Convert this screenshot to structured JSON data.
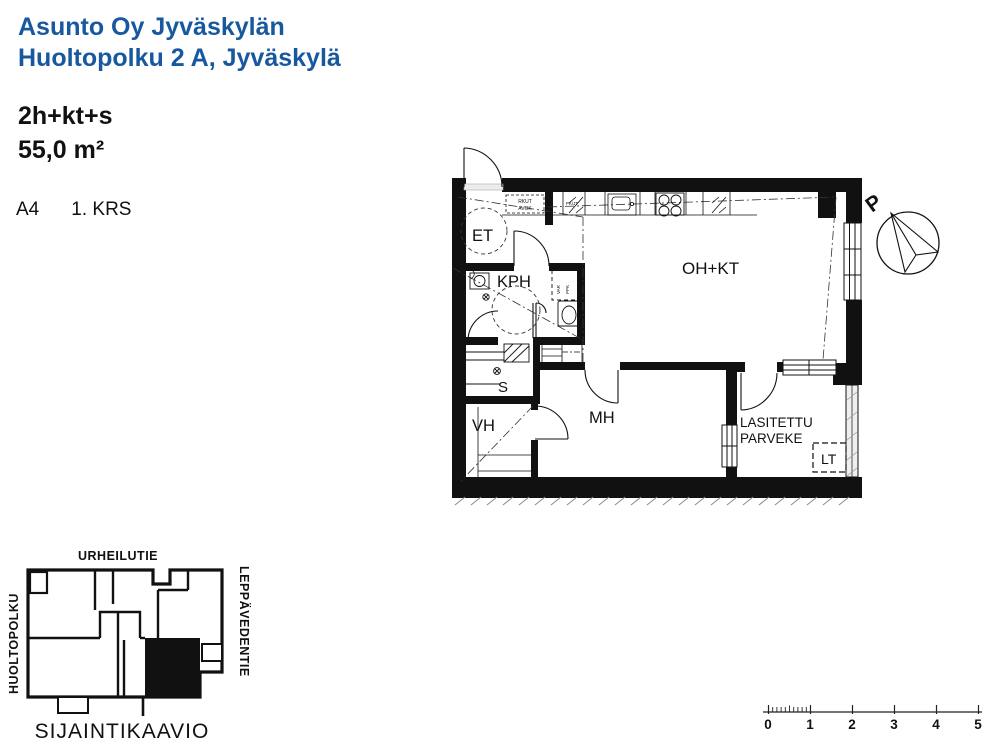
{
  "header": {
    "title_line1": "Asunto Oy Jyväskylän",
    "title_line2": "Huoltopolku 2 A, Jyväskylä",
    "apartment_type": "2h+kt+s",
    "area": "55,0 m²",
    "unit_id": "A4",
    "floor": "1. KRS"
  },
  "floor_plan": {
    "rooms": {
      "entry": "ET",
      "bathroom": "KPH",
      "sauna": "S",
      "closet": "VH",
      "bedroom": "MH",
      "living_kitchen": "OH+KT",
      "balcony_line1": "LASITETTU",
      "balcony_line2": "PARVEKE",
      "balcony_storage": "LT"
    },
    "kitchen_cabinet_label_line1": "RKUT",
    "kitchen_cabinet_label_line2": "AVOK",
    "kitchen_small_label": "PK/JT",
    "laundry_label_line1": "VAR",
    "laundry_label_line2": "PPK",
    "compass_north": "P"
  },
  "site_map": {
    "street_top": "URHEILUTIE",
    "street_left": "HUOLTOPOLKU",
    "street_right": "LEPPÄVEDENTIE",
    "caption": "SIJAINTIKAAVIO"
  },
  "scale_bar": {
    "labels": [
      "0",
      "1",
      "2",
      "3",
      "4",
      "5"
    ]
  },
  "colors": {
    "title_blue": "#17589E",
    "ink": "#111111"
  }
}
